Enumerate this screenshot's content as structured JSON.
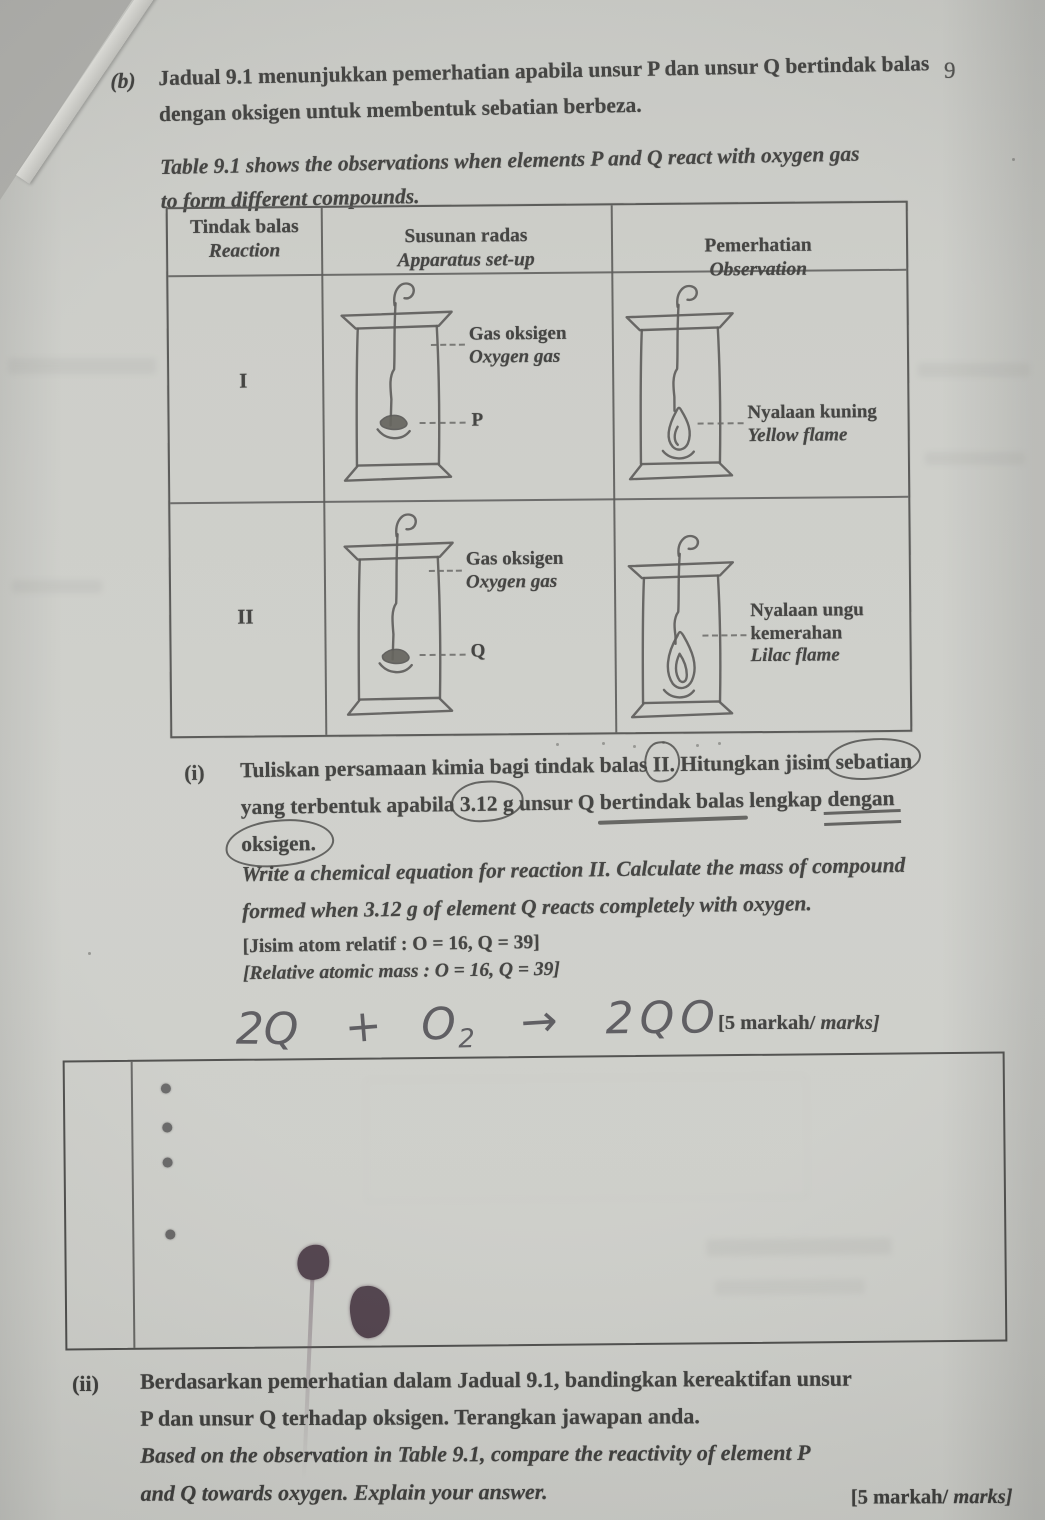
{
  "page": {
    "number": "9"
  },
  "colors": {
    "paper": "#c9cac5",
    "ink": "#343432",
    "ink_blot": "#463641"
  },
  "intro": {
    "label": "(b)",
    "malay_line1": "Jadual 9.1 menunjukkan pemerhatian apabila unsur P dan unsur Q bertindak balas",
    "malay_line2": "dengan oksigen untuk membentuk sebatian berbeza.",
    "english_line1": "Table 9.1 shows the observations when elements P and Q react with oxygen gas",
    "english_line2": "to form different compounds."
  },
  "table": {
    "header_reaction_malay": "Tindak balas",
    "header_reaction_english": "Reaction",
    "header_apparatus_malay": "Susunan radas",
    "header_apparatus_english": "Apparatus set-up",
    "header_observation_malay": "Pemerhatian",
    "header_observation_english": "Observation",
    "row1": {
      "reaction": "I",
      "gas_label_malay": "Gas oksigen",
      "gas_label_english": "Oxygen gas",
      "element_label": "P",
      "observation_malay": "Nyalaan kuning",
      "observation_english": "Yellow flame"
    },
    "row2": {
      "reaction": "II",
      "gas_label_malay": "Gas oksigen",
      "gas_label_english": "Oxygen gas",
      "element_label": "Q",
      "observation_malay_line1": "Nyalaan ungu",
      "observation_malay_line2": "kemerahan",
      "observation_english": "Lilac flame"
    }
  },
  "question_i": {
    "label": "(i)",
    "malay_line1_parts": [
      {
        "t": "Tuliskan persamaan kimia bagi tindak balas "
      },
      {
        "t": "II",
        "s": "circle"
      },
      {
        "t": ". Hitungkan jisim "
      },
      {
        "t": "sebatian",
        "s": "circle"
      }
    ],
    "malay_line2_parts": [
      {
        "t": "yang terbentuk apabila "
      },
      {
        "t": "3.12 g",
        "s": "circle"
      },
      {
        "t": " unsur Q "
      },
      {
        "t": "bertindak balas",
        "s": "underline"
      },
      {
        "t": " lengkap "
      },
      {
        "t": "dengan",
        "s": "dblunderline"
      }
    ],
    "malay_line3_parts": [
      {
        "t": "oksigen.",
        "s": "circle-big"
      }
    ],
    "english_line1": "Write a chemical equation for reaction II. Calculate the mass of compound",
    "english_line2": "formed when 3.12 g of element Q reacts completely with oxygen.",
    "relative_mass_malay": "[Jisim atom relatif : O = 16, Q = 39]",
    "relative_mass_english": "[Relative atomic mass : O = 16, Q = 39]",
    "handwritten_equation": {
      "lhs": "2Q",
      "plus": "+",
      "oxygen": "O",
      "oxygen_subscript": "2",
      "arrow": "→",
      "rhs": "2QO"
    },
    "marks_prefix": "[5 markah/",
    "marks_italic": " marks]"
  },
  "question_ii": {
    "label": "(ii)",
    "malay_line1": "Berdasarkan pemerhatian dalam Jadual 9.1, bandingkan kereaktifan unsur",
    "malay_line2": "P dan unsur Q terhadap oksigen. Terangkan jawapan anda.",
    "english_line1": "Based on the observation in Table 9.1, compare the reactivity of element P",
    "english_line2": "and Q towards oxygen. Explain your answer.",
    "marks_prefix": "[5 markah/",
    "marks_italic": " marks]"
  }
}
